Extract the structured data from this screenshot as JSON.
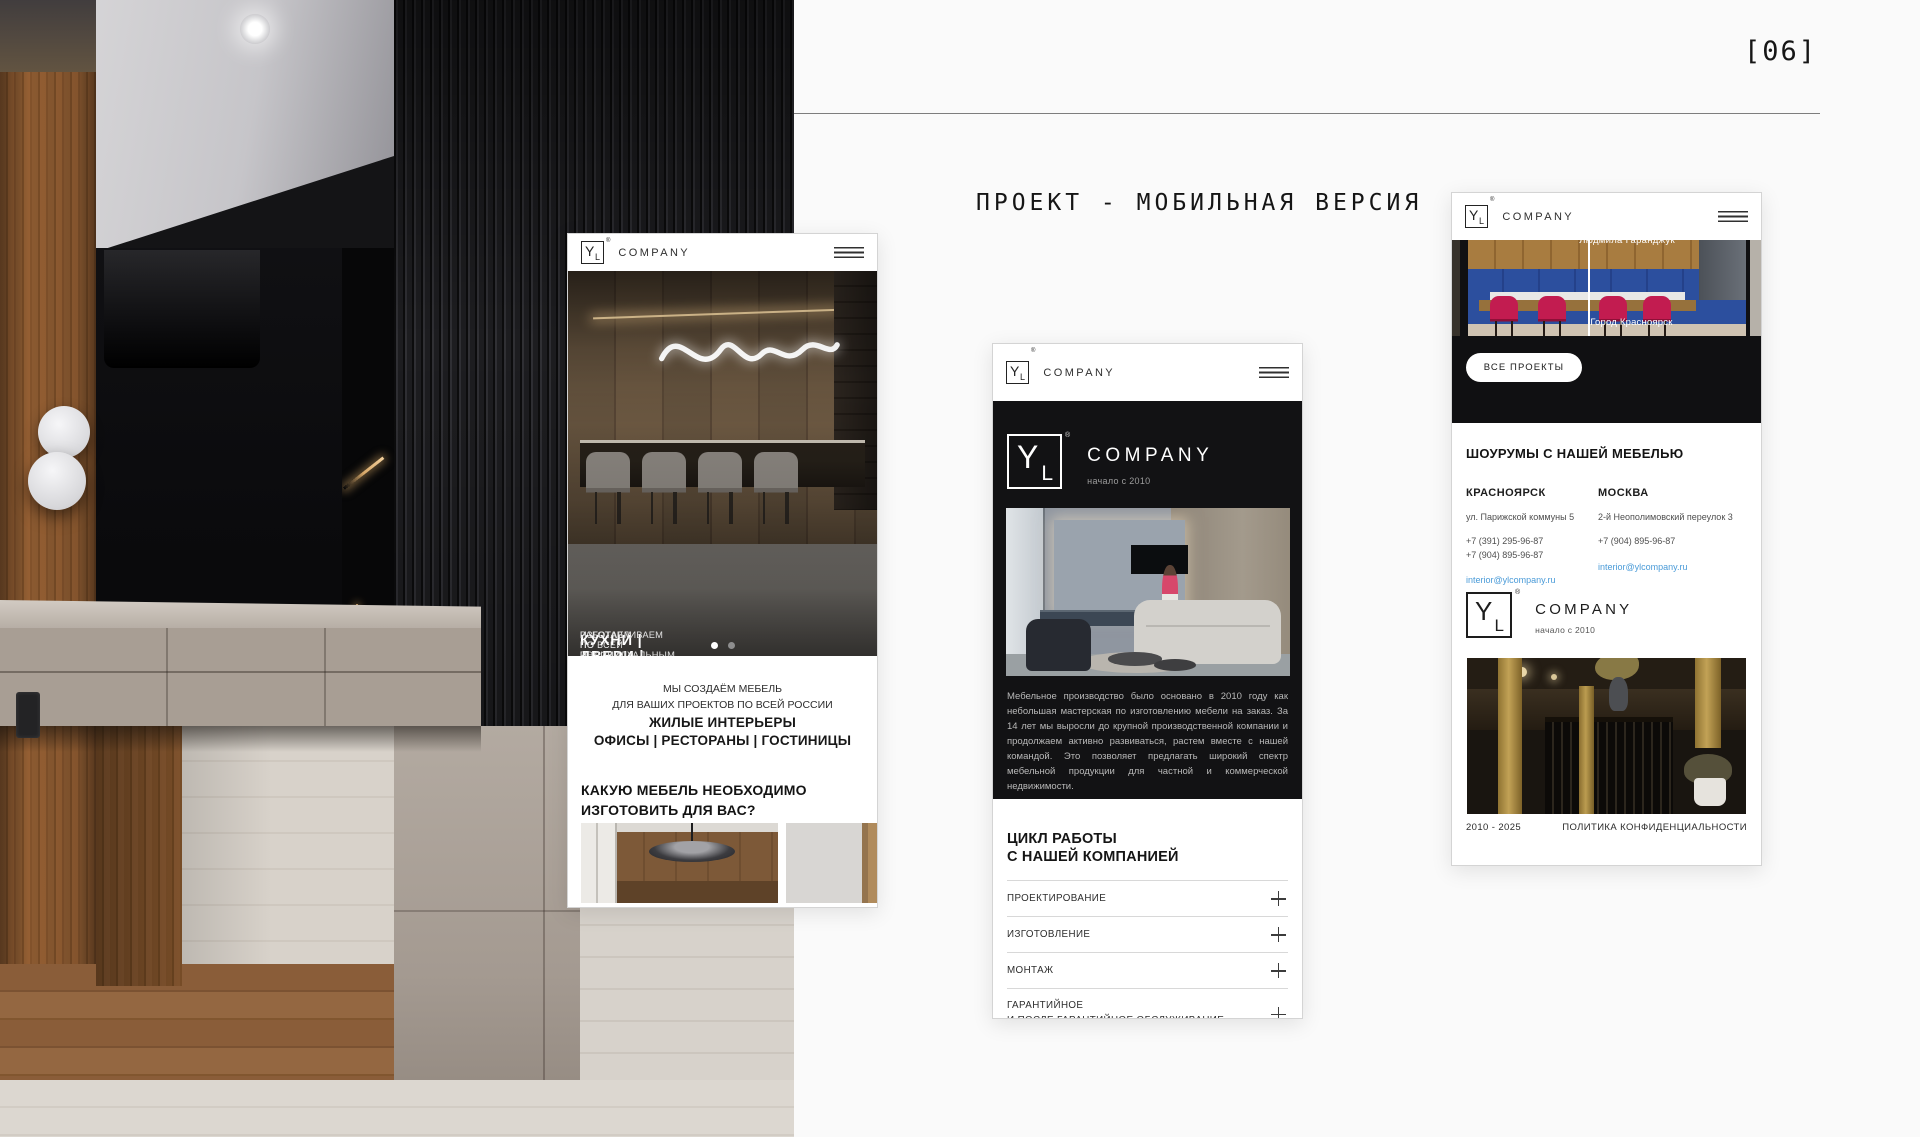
{
  "page": {
    "index_label": "[06]",
    "title": "ПРОЕКТ - МОБИЛЬНАЯ ВЕРСИЯ"
  },
  "brand": {
    "logo_y": "Y",
    "logo_l": "L",
    "registered": "®",
    "name": "COMPANY",
    "since": "начало с 2010"
  },
  "colors": {
    "link_blue": "#4a9bd8",
    "dark_section": "#121214",
    "gold_accent": "#b59a4e"
  },
  "phone_home": {
    "hero": {
      "kicker": "РАБОТАЕМ ПО ВСЕЙ РОССИИ",
      "headline": "КУХНИ | ДВЕРИ | МЕБЕЛЬ",
      "subline": "ИЗГОТАВЛИВАЕМ ПО ИНДИВИДУАЛЬНЫМ ПРОЕКТАМ"
    },
    "intro": {
      "line1": "МЫ СОЗДАЁМ МЕБЕЛЬ",
      "line2": "ДЛЯ ВАШИХ ПРОЕКТОВ ПО ВСЕЙ РОССИИ",
      "line3": "ЖИЛЫЕ ИНТЕРЬЕРЫ",
      "line4": "ОФИСЫ | РЕСТОРАНЫ | ГОСТИНИЦЫ"
    },
    "question": {
      "line1": "КАКУЮ МЕБЕЛЬ НЕОБХОДИМО",
      "line2": "ИЗГОТОВИТЬ ДЛЯ ВАС?"
    }
  },
  "phone_about": {
    "paragraph": "Мебельное производство было основано в 2010 году как небольшая мастерская по изготовлению мебели на заказ. За 14 лет мы выросли до крупной производственной компании и продолжаем активно развиваться, растем вместе с нашей командой. Это позволяет предлагать широкий спектр мебельной продукции для частной и коммерческой недвижимости.",
    "cycle": {
      "title_line1": "ЦИКЛ РАБОТЫ",
      "title_line2": "С НАШЕЙ КОМПАНИЕЙ",
      "items": [
        {
          "line1": "ПРОЕКТИРОВАНИЕ",
          "line2": ""
        },
        {
          "line1": "ИЗГОТОВЛЕНИЕ",
          "line2": ""
        },
        {
          "line1": "МОНТАЖ",
          "line2": ""
        },
        {
          "line1": "ГАРАНТИЙНОЕ",
          "line2": "И ПОСЛЕ ГАРАНТИЙНОЕ ОБСЛУЖИВАНИЕ"
        }
      ]
    }
  },
  "phone_contacts": {
    "project": {
      "author": "Людмила Гаранджук",
      "city_caption": "Город Красноярск",
      "all_projects": "ВСЕ ПРОЕКТЫ"
    },
    "showrooms": {
      "title": "ШОУРУМЫ С НАШЕЙ МЕБЕЛЬЮ",
      "locations": [
        {
          "city": "КРАСНОЯРСК",
          "address": "ул. Парижской коммуны 5",
          "phone1": "+7 (391) 295-96-87",
          "phone2": "+7 (904) 895-96-87",
          "email": "interior@ylcompany.ru"
        },
        {
          "city": "МОСКВА",
          "address": "2-й Неополимовский переулок 3",
          "phone1": "+7 (904) 895-96-87",
          "phone2": "",
          "email": "interior@ylcompany.ru"
        }
      ]
    },
    "footer": {
      "years": "2010 - 2025",
      "policy": "ПОЛИТИКА КОНФИДЕНЦИАЛЬНОСТИ"
    }
  }
}
